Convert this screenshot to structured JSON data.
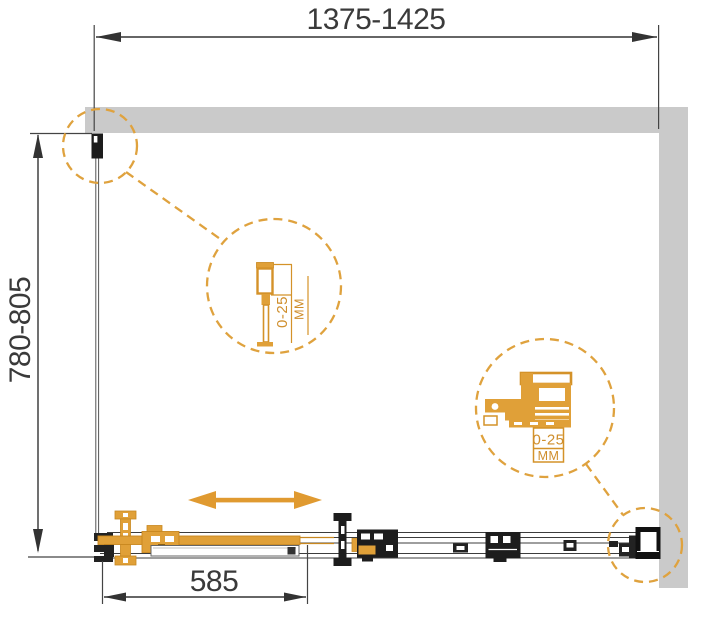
{
  "dimensions": {
    "overall_width": "1375-1425",
    "overall_height": "780-805",
    "door_width": "585"
  },
  "details": {
    "wall_profile": {
      "range": "0-25",
      "unit": "MM"
    },
    "roller": {
      "range": "0-25",
      "unit": "MM"
    }
  },
  "colors": {
    "accent_orange": "#DFA23E",
    "detail_orange": "#E0A038",
    "wall_gray": "#CACACA",
    "line_dark": "#333333"
  }
}
